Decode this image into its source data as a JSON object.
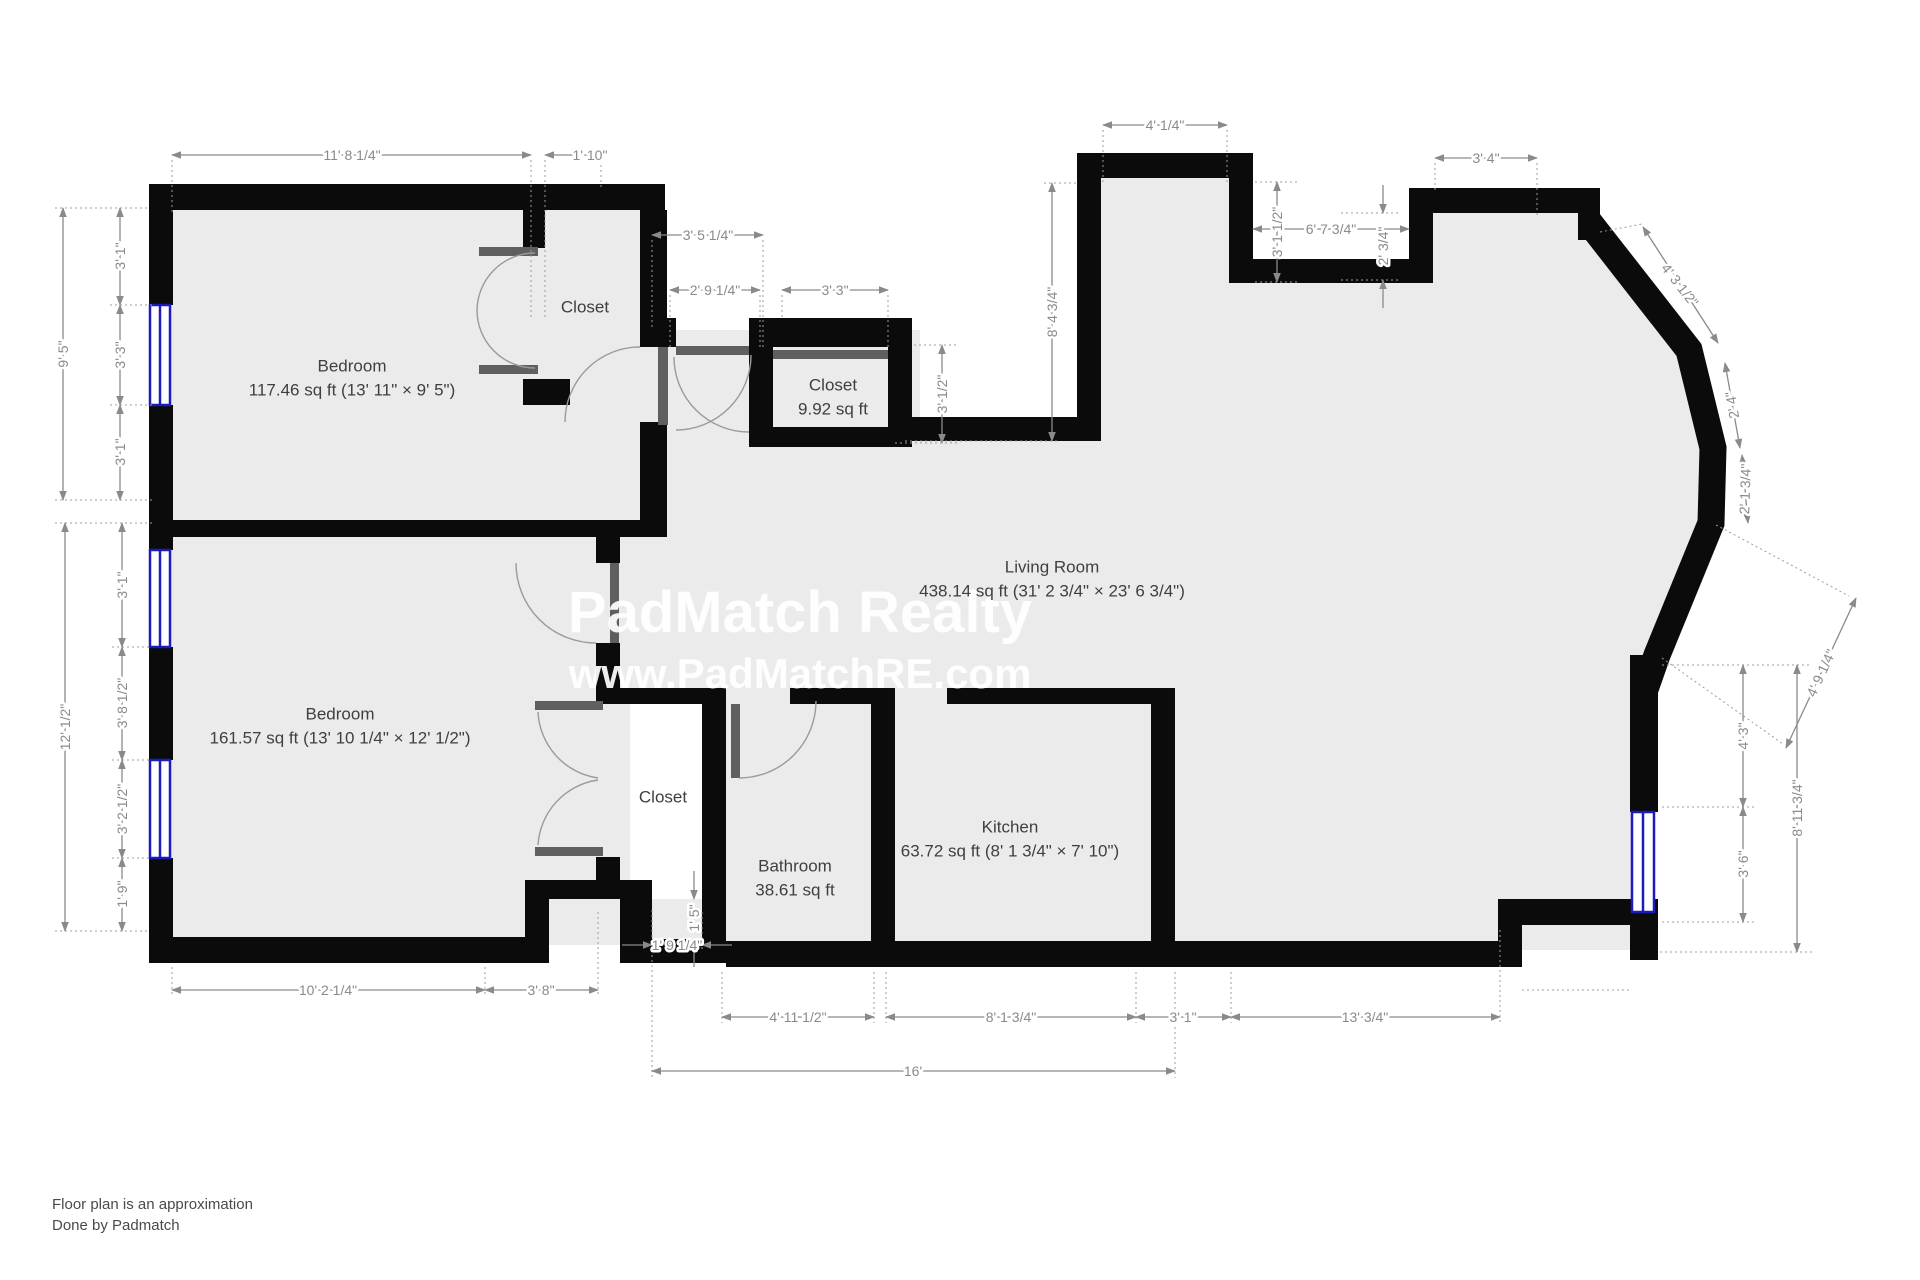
{
  "watermark": {
    "line1": "PadMatch Realty",
    "line2": "www.PadMatchRE.com"
  },
  "footer": {
    "line1": "Floor plan is an approximation",
    "line2": "Done by Padmatch"
  },
  "colors": {
    "wall": "#0b0b0b",
    "floor": "#ebebeb",
    "dimension_text": "#8a8a8a",
    "door": "#5f5f5f",
    "window_blue": "#1b1bbf",
    "room_label": "#3f3f3f",
    "watermark": "#ffffff"
  },
  "rooms": [
    {
      "id": "bedroom-1",
      "name": "Bedroom",
      "area": "117.46 sq ft (13' 11\" × 9' 5\")",
      "x": 352,
      "y": 366
    },
    {
      "id": "bedroom-2",
      "name": "Bedroom",
      "area": "161.57 sq ft (13' 10 1/4\" × 12' 1/2\")",
      "x": 340,
      "y": 714
    },
    {
      "id": "closet-bedroom-1",
      "name": "Closet",
      "area": null,
      "x": 585,
      "y": 307
    },
    {
      "id": "closet-hall",
      "name": "Closet",
      "area": "9.92 sq ft",
      "x": 833,
      "y": 385
    },
    {
      "id": "closet-bedroom-2",
      "name": "Closet",
      "area": null,
      "x": 663,
      "y": 797
    },
    {
      "id": "bathroom",
      "name": "Bathroom",
      "area": "38.61 sq ft",
      "x": 795,
      "y": 866
    },
    {
      "id": "kitchen",
      "name": "Kitchen",
      "area": "63.72 sq ft (8' 1 3/4\" × 7' 10\")",
      "x": 1010,
      "y": 827
    },
    {
      "id": "living-room",
      "name": "Living Room",
      "area": "438.14 sq ft (31' 2 3/4\" × 23' 6 3/4\")",
      "x": 1052,
      "y": 567
    }
  ],
  "dimensions": [
    {
      "text": "11' 8 1/4\"",
      "x": 352,
      "y": 155,
      "rot": 0
    },
    {
      "text": "1' 10\"",
      "x": 590,
      "y": 155,
      "rot": 0
    },
    {
      "text": "3' 5 1/4\"",
      "x": 708,
      "y": 235,
      "rot": 0
    },
    {
      "text": "2' 9 1/4\"",
      "x": 715,
      "y": 290,
      "rot": 0
    },
    {
      "text": "3' 3\"",
      "x": 835,
      "y": 290,
      "rot": 0
    },
    {
      "text": "4' 1/4\"",
      "x": 1165,
      "y": 125,
      "rot": 0
    },
    {
      "text": "6' 7 3/4\"",
      "x": 1331,
      "y": 229,
      "rot": 0
    },
    {
      "text": "3' 4\"",
      "x": 1486,
      "y": 158,
      "rot": 0
    },
    {
      "text": "9' 5\"",
      "x": 63,
      "y": 354,
      "rot": -90
    },
    {
      "text": "3' 1\"",
      "x": 120,
      "y": 256,
      "rot": -90
    },
    {
      "text": "3' 3\"",
      "x": 120,
      "y": 355,
      "rot": -90
    },
    {
      "text": "3' 1\"",
      "x": 120,
      "y": 452,
      "rot": -90
    },
    {
      "text": "12' 1/2\"",
      "x": 65,
      "y": 727,
      "rot": -90
    },
    {
      "text": "3' 1\"",
      "x": 122,
      "y": 585,
      "rot": -90
    },
    {
      "text": "3' 8 1/2\"",
      "x": 122,
      "y": 703,
      "rot": -90
    },
    {
      "text": "3' 2 1/2\"",
      "x": 122,
      "y": 809,
      "rot": -90
    },
    {
      "text": "1' 9\"",
      "x": 122,
      "y": 894,
      "rot": -90
    },
    {
      "text": "8' 4 3/4\"",
      "x": 1052,
      "y": 312,
      "rot": -90
    },
    {
      "text": "3' 1 1/2\"",
      "x": 1277,
      "y": 232,
      "rot": -90
    },
    {
      "text": "2' 3/4\"",
      "x": 1383,
      "y": 246,
      "rot": -90
    },
    {
      "text": "3' 1/2\"",
      "x": 942,
      "y": 394,
      "rot": -90
    },
    {
      "text": "4' 3 1/2\"",
      "x": 1680,
      "y": 285,
      "rot": 52
    },
    {
      "text": "2' 4\"",
      "x": 1732,
      "y": 405,
      "rot": -100
    },
    {
      "text": "2' 1 3/4\"",
      "x": 1745,
      "y": 489,
      "rot": -88
    },
    {
      "text": "4' 9 1/4\"",
      "x": 1821,
      "y": 673,
      "rot": -65
    },
    {
      "text": "4' 3\"",
      "x": 1743,
      "y": 736,
      "rot": -90
    },
    {
      "text": "8' 11 3/4\"",
      "x": 1797,
      "y": 808,
      "rot": -90
    },
    {
      "text": "3' 6\"",
      "x": 1743,
      "y": 864,
      "rot": -90
    },
    {
      "text": "10' 2 1/4\"",
      "x": 328,
      "y": 990,
      "rot": 0
    },
    {
      "text": "3' 8\"",
      "x": 541,
      "y": 990,
      "rot": 0
    },
    {
      "text": "1' 9 1/4\"",
      "x": 677,
      "y": 945,
      "rot": 0
    },
    {
      "text": "1' 5\"",
      "x": 694,
      "y": 918,
      "rot": -90
    },
    {
      "text": "4' 11 1/2\"",
      "x": 798,
      "y": 1017,
      "rot": 0
    },
    {
      "text": "8' 1 3/4\"",
      "x": 1011,
      "y": 1017,
      "rot": 0
    },
    {
      "text": "3' 1\"",
      "x": 1183,
      "y": 1017,
      "rot": 0
    },
    {
      "text": "13' 3/4\"",
      "x": 1365,
      "y": 1017,
      "rot": 0
    },
    {
      "text": "16'",
      "x": 913,
      "y": 1071,
      "rot": 0
    }
  ]
}
